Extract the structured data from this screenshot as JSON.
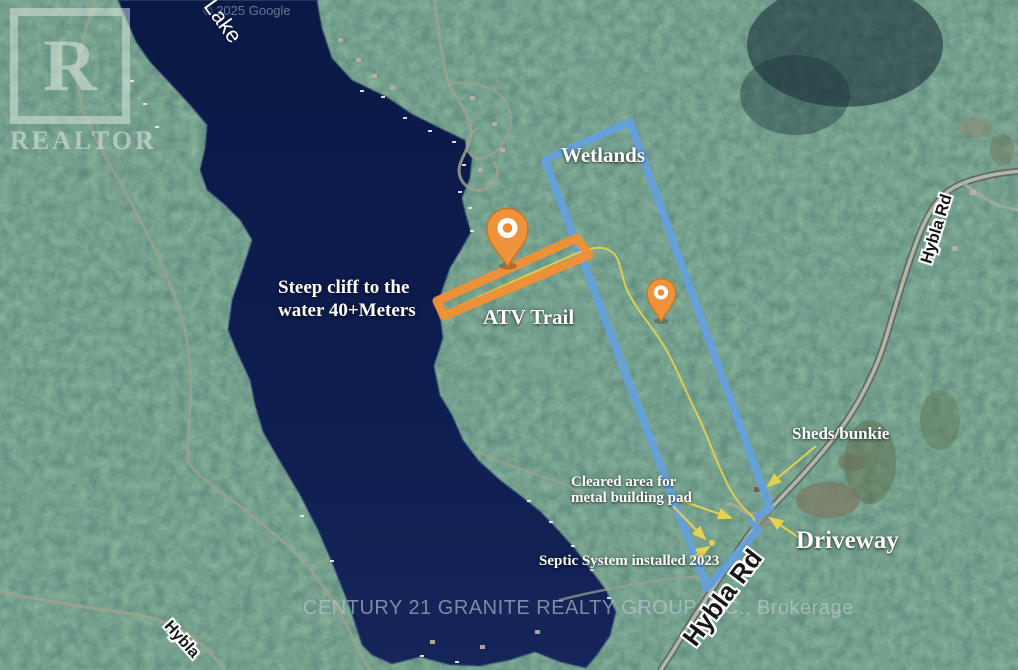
{
  "watermarks": {
    "google_copyright": "© 2025 Google",
    "brokerage": "CENTURY 21 GRANITE REALTY GROUP INC., Brokerage",
    "realtor_logo_letter": "R",
    "realtor_logo_text": "REALTOR"
  },
  "place_labels": {
    "lake": "Lake",
    "hybla_west": "Hybla",
    "hybla_rd_south": "Hybla Rd",
    "hybla_rd_northeast": "Hybla Rd"
  },
  "annotations": {
    "wetlands": "Wetlands",
    "steep_cliff": {
      "line1": "Steep cliff to the",
      "line2": "water 40+Meters"
    },
    "atv_trail": "ATV Trail",
    "sheds_bunkie": "Sheds/bunkie",
    "cleared_area": {
      "line1": "Cleared area for",
      "line2": "metal building pad"
    },
    "septic": "Septic System installed 2023",
    "driveway": "Driveway"
  },
  "colors": {
    "property_boundary": "#64a1dd",
    "trail_highlight": "#ef9136",
    "annotation_line": "#e3d14f",
    "water": "#0d1c4c"
  }
}
